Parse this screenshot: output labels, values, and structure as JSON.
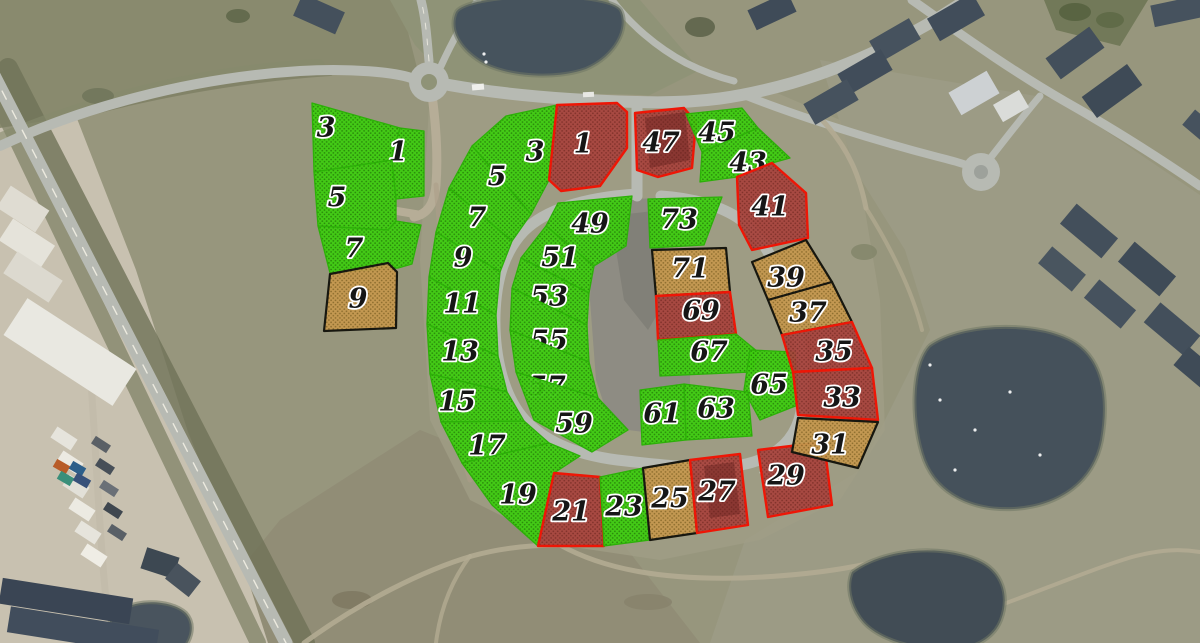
{
  "map": {
    "description": "Aerial photo of a residential development with 42 numbered building plots outlined in green, red and orange hatch overlays",
    "plot_count": 42
  },
  "palette": {
    "statuses": {
      "green": {
        "fill": "#3ecd10",
        "dot": "#238704",
        "stroke": "#2cb008",
        "stroke_w": 1.3
      },
      "red": {
        "fill": "#a8453e",
        "dot": "#7e2b25",
        "stroke": "#ee1606",
        "stroke_w": 2.4
      },
      "orange": {
        "fill": "#c5984f",
        "dot": "#8b6a28",
        "stroke": "#17170f",
        "stroke_w": 2.2
      }
    },
    "base": "#97967d",
    "road": "#b7bab3",
    "water": "#46535d",
    "label_fill": "#161616",
    "label_stroke": "#ffffff"
  },
  "background": {
    "fields": [
      {
        "rect": [
          0,
          0,
          1200,
          643
        ],
        "c": "#97967d"
      },
      {
        "p": "0,0 400,0 420,80 320,68 180,82 60,120 0,146",
        "c": "#898a6e"
      },
      {
        "p": "390,0 640,0 700,70 640,100 460,92 415,45",
        "c": "#8f9377"
      },
      {
        "p": "820,60 1060,100 1200,195 1200,643 710,643 745,540 860,470 930,330 905,250 855,170",
        "c": "#9c9b85"
      },
      {
        "p": "180,643 280,520 420,430 520,470 620,540 700,643",
        "c": "#908c75",
        "o": 0.9
      },
      {
        "p": "1044,0 1148,0 1120,46 1056,30",
        "c": "#6b7452",
        "o": 0.85
      },
      {
        "p": "0,128 76,116 136,270 188,432 248,580 268,643 0,643",
        "c": "#c8c1b0"
      },
      {
        "p": "430,90 640,95 700,100 770,90 840,120 865,210 880,300 885,430 840,500 760,540 660,560 560,545 470,500 430,420 420,260",
        "c": "#a09e86",
        "o": 0.8
      },
      {
        "p": "600,200 662,198 666,262 668,330 690,366 690,394 644,432 612,428 596,380 590,300 592,240",
        "c": "#8e8c83"
      },
      {
        "p": "618,215 662,210 666,300 648,330 624,300 616,250",
        "c": "#7e7d75",
        "o": 0.8
      }
    ],
    "hedges": [
      {
        "d": "M8,68 L305,643",
        "w": 20,
        "c": "#6f7257",
        "o": 0.8
      },
      {
        "d": "M-30,42 L258,643",
        "w": 16,
        "c": "#7b7e63",
        "o": 0.7
      },
      {
        "d": "M0,140 C90,102 200,72 318,66",
        "w": 14,
        "c": "#868a6c",
        "o": 0.6
      },
      {
        "d": "M60,120 C140,96 240,78 330,72",
        "w": 8,
        "c": "#6d7054",
        "o": 0.5
      }
    ],
    "scrub": [
      [
        238,
        16,
        12,
        7,
        "#5e6549"
      ],
      [
        700,
        27,
        15,
        10,
        "#5a6148"
      ],
      [
        98,
        96,
        16,
        8,
        "#70745a"
      ],
      [
        864,
        252,
        13,
        8,
        "#82866a"
      ],
      [
        352,
        600,
        20,
        9,
        "#7e7862"
      ],
      [
        648,
        602,
        24,
        8,
        "#87826c"
      ],
      [
        1075,
        12,
        16,
        9,
        "#55603e"
      ],
      [
        1110,
        20,
        14,
        8,
        "#5d6845"
      ]
    ],
    "gravel_roads": [
      {
        "d": "M432,95 C436,125 438,158 436,185 C434,205 427,214 414,217",
        "w": 9,
        "c": "#b6ad97"
      },
      {
        "d": "M421,215 L397,211",
        "w": 8,
        "c": "#b6ad97"
      },
      {
        "d": "M436,185 C442,250 446,310 452,380 C455,420 462,455 470,480",
        "w": 5,
        "c": "#ab9f88",
        "o": 0.6
      }
    ],
    "roads": [
      {
        "d": "M-18,52 L286,643",
        "w": 13
      },
      {
        "d": "M0,146 C80,108 190,78 300,71 C350,68 396,72 414,79",
        "w": 10
      },
      {
        "d": "M429,61 C427,40 426,20 421,0",
        "w": 9
      },
      {
        "d": "M441,66 C452,42 464,20 478,0",
        "w": 7
      },
      {
        "d": "M449,85 C505,95 565,100 637,102 C702,104 742,97 792,83 C850,66 912,37 966,0",
        "w": 12
      },
      {
        "d": "M612,0 C630,24 656,47 686,63 C702,71 718,77 734,81",
        "w": 7
      },
      {
        "d": "M744,95 C802,118 880,142 938,157 C958,162 972,166 979,171",
        "w": 8
      },
      {
        "d": "M912,0 C952,28 1010,70 1066,102 C1112,128 1162,160 1200,186",
        "w": 9
      },
      {
        "d": "M981,170 C1000,146 1018,122 1040,96",
        "w": 7
      },
      {
        "d": "M637,103 L637,196",
        "w": 11
      },
      {
        "d": "M637,194 C592,197 548,207 524,231 C504,252 496,280 495,315 C494,355 503,396 525,420 C549,446 586,457 626,461 C670,466 712,470 741,465 C773,459 795,442 801,412 C807,376 801,334 789,299 C777,264 761,235 741,220 C722,206 692,198 661,196",
        "w": 11
      },
      {
        "d": "M90,368 C96,450 99,530 106,600 L110,643",
        "w": 7,
        "c": "#c3bcab"
      }
    ],
    "road_dashes": [
      {
        "d": "M-18,52 L286,643",
        "w": 1.4,
        "c": "#eceadf",
        "dash": "9 13"
      },
      {
        "d": "M429,61 C427,40 426,20 421,0",
        "w": 1,
        "c": "#e8e6dc",
        "dash": "6 10"
      }
    ],
    "trails": [
      {
        "d": "M560,545 C605,570 665,580 742,578 C822,575 876,564 906,553",
        "w": 5
      },
      {
        "d": "M304,643 C360,602 424,570 472,556 C504,547 534,545 560,545",
        "w": 5
      },
      {
        "d": "M906,553 C938,545 952,560 958,588 C962,612 956,632 948,643",
        "w": 4
      },
      {
        "d": "M958,620 C1020,600 1082,572 1132,557 C1162,549 1182,549 1200,552",
        "w": 4
      },
      {
        "d": "M822,120 C850,150 860,178 866,208",
        "w": 5
      },
      {
        "d": "M866,208 C890,246 912,290 922,330",
        "w": 4,
        "o": 0.7
      },
      {
        "d": "M470,556 C452,580 440,610 436,643",
        "w": 4,
        "o": 0.8
      }
    ],
    "roundabout": {
      "cx": 429,
      "cy": 82,
      "r": 20,
      "inner_r": 8,
      "inner_c": "#8f9377"
    },
    "culdesac": {
      "cx": 981,
      "cy": 172,
      "r": 19,
      "inner_r": 7,
      "inner_c": "#9da19b"
    },
    "ponds": [
      {
        "d": "M456,12 C468,-8 608,-10 621,10 C630,28 616,56 586,69 C556,80 506,77 481,62 C460,49 448,30 456,12",
        "c": "#46535d"
      },
      {
        "d": "M929,346 C958,324 1030,320 1069,339 C1102,355 1110,394 1102,440 C1094,482 1060,506 1014,509 C974,511 938,496 924,460 C911,424 910,368 929,346",
        "c": "#45515b"
      },
      {
        "d": "M852,572 C884,548 942,544 978,560 C1003,571 1010,596 1001,620 C993,641 968,652 940,650 C908,648 874,638 860,618 C850,604 846,586 852,572",
        "c": "#414c55"
      },
      {
        "d": "M112,617 C128,598 170,598 186,613 C196,624 192,640 182,650 C166,662 130,660 118,646 C110,636 106,626 112,617",
        "c": "#49545e"
      }
    ],
    "birds": [
      [
        940,
        400
      ],
      [
        975,
        430
      ],
      [
        1010,
        392
      ],
      [
        955,
        470
      ],
      [
        1040,
        455
      ],
      [
        930,
        365
      ],
      [
        484,
        54
      ],
      [
        486,
        62
      ]
    ],
    "construction": [
      [
        5,
        330,
        130,
        44,
        33,
        "#e9e8e1"
      ],
      [
        0,
        196,
        46,
        26,
        33,
        "#dfdcd2"
      ],
      [
        2,
        230,
        50,
        26,
        33,
        "#e5e3da"
      ],
      [
        6,
        264,
        54,
        26,
        33,
        "#dcd9cf"
      ],
      [
        52,
        432,
        24,
        13,
        33,
        "#e6e4dc"
      ],
      [
        58,
        456,
        24,
        13,
        33,
        "#eceae2"
      ],
      [
        64,
        480,
        24,
        13,
        33,
        "#e2e0d8"
      ],
      [
        70,
        503,
        24,
        13,
        33,
        "#eceae2"
      ],
      [
        76,
        526,
        24,
        13,
        33,
        "#e6e4dc"
      ],
      [
        82,
        549,
        24,
        13,
        33,
        "#efede5"
      ],
      [
        92,
        440,
        18,
        9,
        33,
        "#5a6066"
      ],
      [
        96,
        462,
        18,
        9,
        33,
        "#474f58"
      ],
      [
        100,
        484,
        18,
        9,
        33,
        "#6a7077"
      ],
      [
        104,
        506,
        18,
        9,
        33,
        "#3f474f"
      ],
      [
        108,
        528,
        18,
        9,
        33,
        "#596067"
      ],
      [
        54,
        462,
        15,
        9,
        30,
        "#b85c28"
      ],
      [
        70,
        464,
        15,
        9,
        30,
        "#2d5f8a"
      ],
      [
        58,
        474,
        15,
        9,
        30,
        "#3a8f7a"
      ],
      [
        74,
        476,
        16,
        9,
        30,
        "#37517a"
      ]
    ],
    "houses": [
      [
        296,
        2,
        46,
        24,
        24,
        "#44505c"
      ],
      [
        750,
        0,
        44,
        22,
        -25,
        "#3f4b58"
      ],
      [
        930,
        4,
        52,
        26,
        -30,
        "#414d5a"
      ],
      [
        872,
        28,
        46,
        24,
        -30,
        "#46525e"
      ],
      [
        840,
        60,
        50,
        24,
        -30,
        "#414d5a"
      ],
      [
        806,
        90,
        50,
        24,
        -30,
        "#46525e"
      ],
      [
        952,
        80,
        44,
        26,
        -30,
        "#cdd1d3"
      ],
      [
        996,
        96,
        30,
        20,
        -30,
        "#dadcd9"
      ],
      [
        1048,
        40,
        54,
        26,
        -36,
        "#434f5b"
      ],
      [
        1084,
        78,
        56,
        26,
        -36,
        "#3e4a56"
      ],
      [
        1152,
        0,
        52,
        22,
        -12,
        "#46525e"
      ],
      [
        1184,
        120,
        40,
        20,
        40,
        "#46525e"
      ],
      [
        1062,
        218,
        54,
        26,
        40,
        "#434f5b"
      ],
      [
        1120,
        256,
        54,
        26,
        40,
        "#3f4b57"
      ],
      [
        1086,
        292,
        48,
        24,
        40,
        "#46525e"
      ],
      [
        1146,
        316,
        52,
        26,
        40,
        "#434f5b"
      ],
      [
        1176,
        358,
        44,
        24,
        40,
        "#3f4b57"
      ],
      [
        1040,
        258,
        44,
        22,
        40,
        "#49555f"
      ],
      [
        0,
        588,
        132,
        26,
        9,
        "#3a4554"
      ],
      [
        8,
        618,
        150,
        26,
        9,
        "#414d5c"
      ],
      [
        143,
        552,
        34,
        22,
        18,
        "#3d4852"
      ],
      [
        168,
        570,
        30,
        20,
        38,
        "#49535d"
      ]
    ],
    "cars": [
      [
        472,
        84,
        12,
        6,
        -5,
        "#efefec"
      ],
      [
        583,
        92,
        11,
        5,
        -3,
        "#e8e8e4"
      ],
      [
        760,
        470,
        10,
        5,
        20,
        "#dfe0dc"
      ]
    ]
  },
  "parcels": [
    {
      "n": "3",
      "s": "green",
      "p": "312,103 400,128 392,160 314,172",
      "lx": 326,
      "ly": 128
    },
    {
      "n": "1",
      "s": "green",
      "p": "400,128 424,131 424,196 396,199 390,162",
      "lx": 398,
      "ly": 152
    },
    {
      "n": "5",
      "s": "green",
      "p": "314,172 392,160 396,199 396,221 388,230 318,226",
      "lx": 337,
      "ly": 198
    },
    {
      "n": "7",
      "s": "green",
      "p": "318,226 388,230 396,221 421,225 412,264 398,268 330,273",
      "lx": 354,
      "ly": 249
    },
    {
      "n": "9",
      "s": "orange",
      "p": "330,274 388,263 397,272 396,328 324,331",
      "lx": 358,
      "ly": 299
    },
    {
      "n": "3",
      "s": "green",
      "p": "506,116 557,105 549,180 531,214 472,146",
      "lx": 535,
      "ly": 152
    },
    {
      "n": "1",
      "s": "red",
      "p": "557,105 617,103 627,112 627,148 600,186 561,191 549,180",
      "lx": 583,
      "ly": 144
    },
    {
      "n": "5",
      "s": "green",
      "p": "472,146 531,214 512,241 449,188",
      "lx": 497,
      "ly": 177
    },
    {
      "n": "7",
      "s": "green",
      "p": "449,188 512,241 500,272 436,232",
      "lx": 477,
      "ly": 218
    },
    {
      "n": "9",
      "s": "green",
      "p": "436,232 500,272 496,315 429,277",
      "lx": 463,
      "ly": 258
    },
    {
      "n": "11",
      "s": "green",
      "p": "429,277 496,315 498,356 427,324",
      "lx": 462,
      "ly": 304
    },
    {
      "n": "13",
      "s": "green",
      "p": "427,324 498,356 507,392 430,374",
      "lx": 460,
      "ly": 352
    },
    {
      "n": "15",
      "s": "green",
      "p": "430,374 507,392 524,421 441,422",
      "lx": 457,
      "ly": 402
    },
    {
      "n": "17",
      "s": "green",
      "p": "441,422 524,421 549,443 462,463",
      "lx": 487,
      "ly": 446
    },
    {
      "n": "19",
      "s": "green",
      "p": "462,463 549,443 580,456 554,473 538,546 492,505",
      "lx": 518,
      "ly": 495
    },
    {
      "n": "21",
      "s": "red",
      "p": "554,473 600,477 604,546 538,546",
      "lx": 571,
      "ly": 512
    },
    {
      "n": "23",
      "s": "green",
      "p": "600,477 643,468 650,540 604,546",
      "lx": 624,
      "ly": 507
    },
    {
      "n": "25",
      "s": "orange",
      "p": "643,468 690,460 697,533 650,540",
      "lx": 670,
      "ly": 499
    },
    {
      "n": "27",
      "s": "red",
      "p": "690,460 740,454 748,525 697,533",
      "patch": "704,466 734,462 740,514 710,518",
      "lx": 717,
      "ly": 492
    },
    {
      "n": "29",
      "s": "red",
      "p": "758,450 824,442 832,505 768,517",
      "lx": 786,
      "ly": 476
    },
    {
      "n": "47",
      "s": "red",
      "p": "635,113 684,108 696,122 692,168 658,177 637,170",
      "patch": "645,118 685,112 690,160 650,168",
      "lx": 661,
      "ly": 143
    },
    {
      "n": "45",
      "s": "green",
      "p": "686,114 742,108 758,128 702,152",
      "lx": 717,
      "ly": 133
    },
    {
      "n": "43",
      "s": "green",
      "p": "702,152 758,128 790,158 772,163 737,177 700,182",
      "lx": 748,
      "ly": 163
    },
    {
      "n": "41",
      "s": "red",
      "p": "737,177 772,163 806,193 808,238 752,250 739,225",
      "lx": 770,
      "ly": 207
    },
    {
      "n": "49",
      "s": "green",
      "p": "558,203 632,196 626,246 594,266 546,226",
      "lx": 590,
      "ly": 224
    },
    {
      "n": "51",
      "s": "green",
      "p": "546,226 594,266 589,293 521,258",
      "lx": 560,
      "ly": 258
    },
    {
      "n": "53",
      "s": "green",
      "p": "521,258 589,293 587,325 512,288",
      "lx": 549,
      "ly": 297
    },
    {
      "n": "55",
      "s": "green",
      "p": "512,288 587,325 589,362 510,330",
      "lx": 549,
      "ly": 341
    },
    {
      "n": "57",
      "s": "green",
      "p": "510,330 589,362 598,398 516,372",
      "lx": 547,
      "ly": 387
    },
    {
      "n": "59",
      "s": "green",
      "p": "516,372 598,398 628,430 592,452 534,420",
      "lx": 574,
      "ly": 424
    },
    {
      "n": "73",
      "s": "green",
      "p": "648,199 722,197 704,245 650,248",
      "lx": 679,
      "ly": 220
    },
    {
      "n": "71",
      "s": "orange",
      "p": "652,250 726,248 730,292 656,296",
      "lx": 690,
      "ly": 269
    },
    {
      "n": "69",
      "s": "red",
      "p": "656,296 730,292 736,334 658,340",
      "lx": 701,
      "ly": 311
    },
    {
      "n": "67",
      "s": "green",
      "p": "658,340 736,334 758,352 752,372 660,376",
      "lx": 709,
      "ly": 352
    },
    {
      "n": "65",
      "s": "green",
      "p": "750,350 795,352 798,405 760,420 744,390",
      "lx": 769,
      "ly": 385
    },
    {
      "n": "63",
      "s": "green",
      "p": "684,384 748,392 752,436 686,440",
      "lx": 716,
      "ly": 409
    },
    {
      "n": "61",
      "s": "green",
      "p": "640,390 684,384 686,440 642,445",
      "lx": 662,
      "ly": 414
    },
    {
      "n": "39",
      "s": "orange",
      "p": "752,262 806,240 832,282 768,300",
      "lx": 786,
      "ly": 278
    },
    {
      "n": "37",
      "s": "orange",
      "p": "768,300 832,282 852,322 782,335",
      "lx": 808,
      "ly": 313
    },
    {
      "n": "35",
      "s": "red",
      "p": "782,335 852,322 872,368 793,372",
      "lx": 834,
      "ly": 352
    },
    {
      "n": "33",
      "s": "red",
      "p": "793,372 872,368 878,420 798,415",
      "lx": 842,
      "ly": 398
    },
    {
      "n": "31",
      "s": "orange",
      "p": "798,418 878,422 858,468 792,452",
      "lx": 830,
      "ly": 445
    }
  ]
}
